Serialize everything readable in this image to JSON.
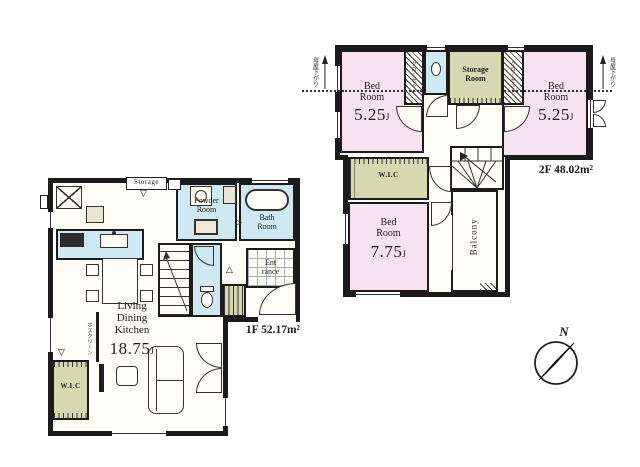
{
  "colors": {
    "wall": "#1b1b1b",
    "room_pink": "#f7e2f0",
    "room_green": "#d6d8b2",
    "room_blue": "#cfe9f2",
    "floor": "#fffdf6"
  },
  "floor1": {
    "area_label": "1F 52.17m²",
    "ldk": {
      "line1": "Living",
      "line2": "Dining",
      "line3": "Kitchen",
      "size": "18.75",
      "size_unit": "J"
    },
    "powder_room": {
      "line1": "Powder",
      "line2": "Room"
    },
    "bath_room": {
      "line1": "Bath",
      "line2": "Room"
    },
    "entrance": {
      "line1": "Ent",
      "line2": "rance"
    },
    "wic": "W.I.C",
    "storage": "Storage",
    "hoscreen": "ホスクリーン"
  },
  "floor2": {
    "area_label": "2F 48.02m²",
    "bedroom_left": {
      "line1": "Bed",
      "line2": "Room",
      "size": "5.25",
      "size_unit": "J"
    },
    "bedroom_right": {
      "line1": "Bed",
      "line2": "Room",
      "size": "5.25",
      "size_unit": "J"
    },
    "bedroom_main": {
      "line1": "Bed",
      "line2": "Room",
      "size": "7.75",
      "size_unit": "J"
    },
    "storage_room": {
      "line1": "Storage",
      "line2": "Room"
    },
    "wic": "W.I.C",
    "balcony": "Balcony",
    "closet_left": "クローゼット",
    "closet_right": "クローゼット",
    "eaves_note_left": "母屋下がり",
    "eaves_note_right": "母屋下がり"
  },
  "compass": {
    "north": "N"
  }
}
